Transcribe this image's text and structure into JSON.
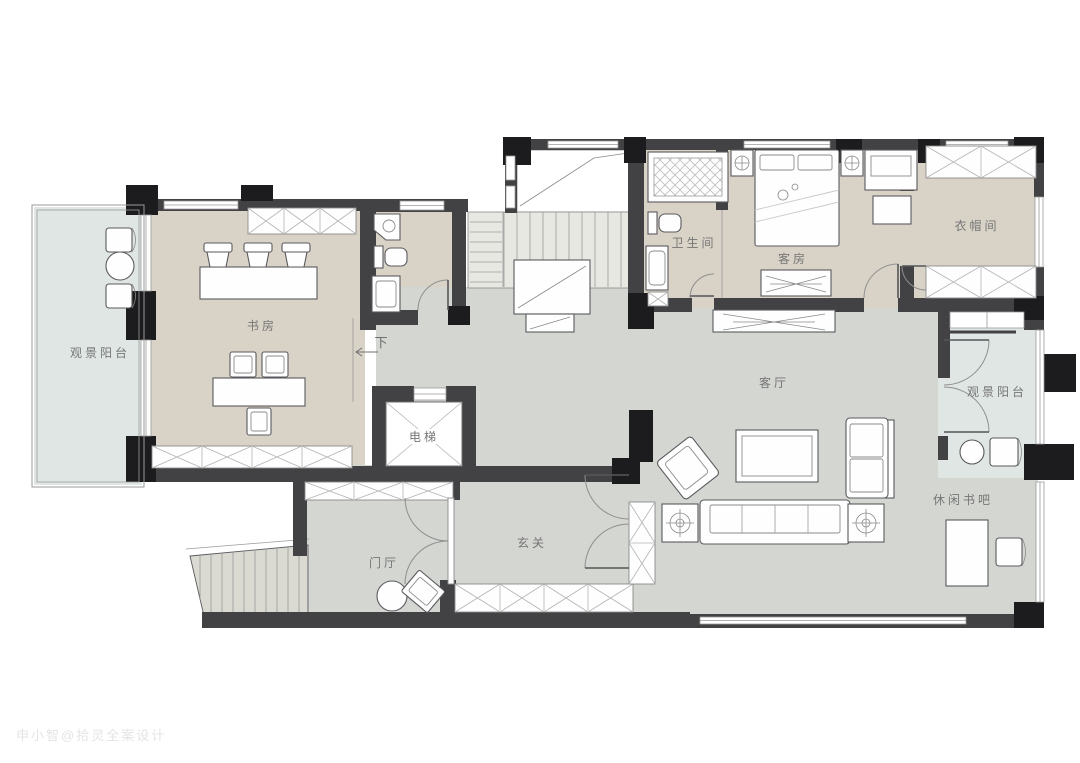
{
  "plan": {
    "watermark": "申小智@拾灵全案设计",
    "palette": {
      "wall": "#424244",
      "pillar": "#1c1c1e",
      "floor_warm": "#d9d3c7",
      "floor_cool": "#d4d6d2",
      "floor_balcony": "#dfe6e3",
      "label": "#767676"
    },
    "rooms": [
      {
        "id": "balcony-left",
        "label": "观景阳台"
      },
      {
        "id": "study",
        "label": "书房"
      },
      {
        "id": "guest-bathroom",
        "label": "卫生间"
      },
      {
        "id": "guest-room",
        "label": "客房"
      },
      {
        "id": "cloakroom",
        "label": "衣帽间"
      },
      {
        "id": "living-room",
        "label": "客厅"
      },
      {
        "id": "balcony-right",
        "label": "观景阳台"
      },
      {
        "id": "reading-bar",
        "label": "休闲书吧"
      },
      {
        "id": "entrance-hall",
        "label": "玄关"
      },
      {
        "id": "foyer",
        "label": "门厅"
      },
      {
        "id": "elevator",
        "label": "电梯"
      },
      {
        "id": "stairs-down",
        "label": "下"
      }
    ]
  }
}
